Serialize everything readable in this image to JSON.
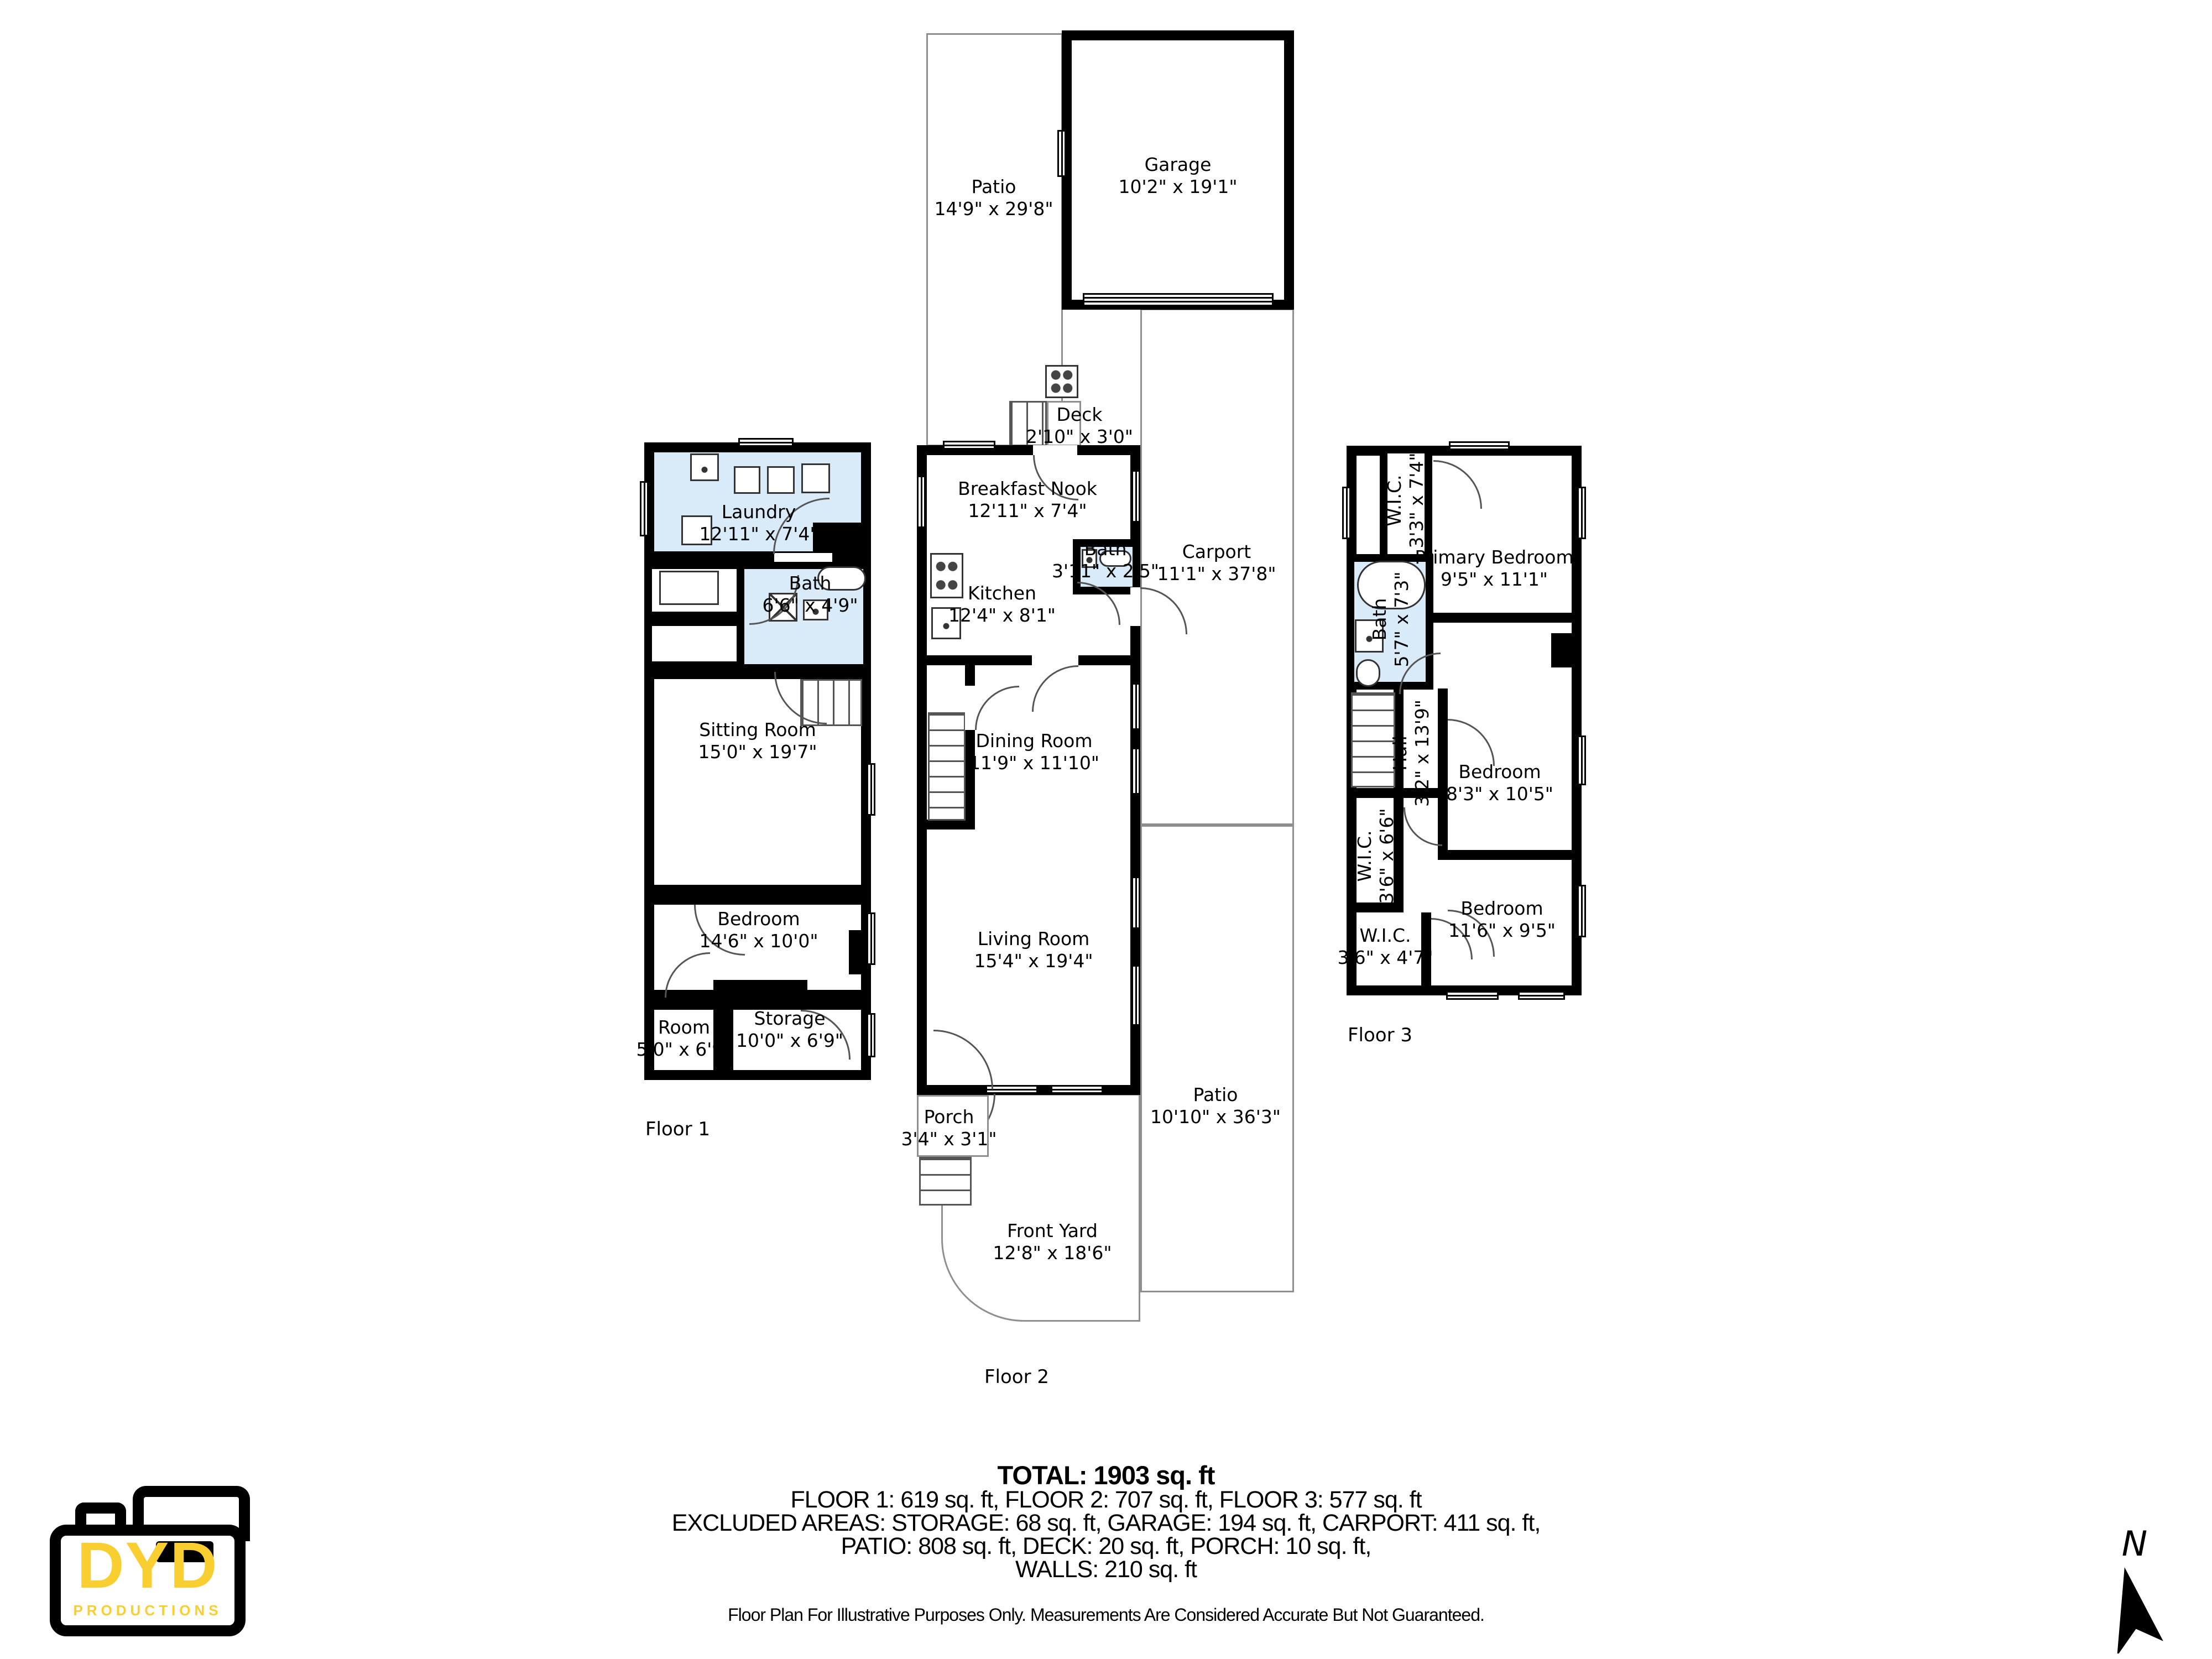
{
  "plan": {
    "floor1": {
      "label": "Floor 1",
      "laundry": {
        "name": "Laundry",
        "dims": "12'11\" x 7'4\""
      },
      "bath": {
        "name": "Bath",
        "dims": "6'6\" x 4'9\""
      },
      "sitting": {
        "name": "Sitting Room",
        "dims": "15'0\" x 19'7\""
      },
      "bedroom": {
        "name": "Bedroom",
        "dims": "14'6\" x 10'0\""
      },
      "room": {
        "name": "Room",
        "dims": "5'0\" x 6'9\""
      },
      "storage": {
        "name": "Storage",
        "dims": "10'0\" x 6'9\""
      }
    },
    "floor2": {
      "label": "Floor 2",
      "patio_back": {
        "name": "Patio",
        "dims": "14'9\" x 29'8\""
      },
      "garage": {
        "name": "Garage",
        "dims": "10'2\" x 19'1\""
      },
      "deck": {
        "name": "Deck",
        "dims": "2'10\" x 3'0\""
      },
      "breakfast": {
        "name": "Breakfast Nook",
        "dims": "12'11\" x 7'4\""
      },
      "bath": {
        "name": "Bath",
        "dims": "3'11\" x 2'5\""
      },
      "carport": {
        "name": "Carport",
        "dims": "11'1\" x 37'8\""
      },
      "kitchen": {
        "name": "Kitchen",
        "dims": "12'4\" x 8'1\""
      },
      "dining": {
        "name": "Dining Room",
        "dims": "11'9\" x 11'10\""
      },
      "living": {
        "name": "Living Room",
        "dims": "15'4\" x 19'4\""
      },
      "porch": {
        "name": "Porch",
        "dims": "3'4\" x 3'1\""
      },
      "patio_front": {
        "name": "Patio",
        "dims": "10'10\" x 36'3\""
      },
      "front_yard": {
        "name": "Front Yard",
        "dims": "12'8\" x 18'6\""
      }
    },
    "floor3": {
      "label": "Floor 3",
      "wic_top": {
        "name": "W.I.C.",
        "dims": "3'3\" x 7'4\""
      },
      "primary": {
        "name": "Primary Bedroom",
        "dims": "9'5\" x 11'1\""
      },
      "bath": {
        "name": "Bath",
        "dims": "5'7\" x 7'3\""
      },
      "hall": {
        "name": "Hall",
        "dims": "3'2\" x 13'9\""
      },
      "bedroom_mid": {
        "name": "Bedroom",
        "dims": "8'3\" x 10'5\""
      },
      "wic_mid": {
        "name": "W.I.C.",
        "dims": "3'6\" x 6'6\""
      },
      "wic_bottom": {
        "name": "W.I.C.",
        "dims": "3'6\" x 4'7\""
      },
      "bedroom_bottom": {
        "name": "Bedroom",
        "dims": "11'6\" x 9'5\""
      }
    }
  },
  "summary": {
    "total": "TOTAL: 1903 sq. ft",
    "floors_line": "FLOOR 1: 619 sq. ft, FLOOR 2: 707 sq. ft, FLOOR 3: 577 sq. ft",
    "excluded_line": "EXCLUDED AREAS: STORAGE: 68 sq. ft, GARAGE: 194 sq. ft, CARPORT: 411 sq. ft,",
    "areas_line": "PATIO: 808 sq. ft, DECK: 20 sq. ft, PORCH: 10 sq. ft,",
    "walls_line": "WALLS: 210 sq. ft",
    "disclaimer": "Floor Plan For Illustrative Purposes Only. Measurements Are Considered Accurate But Not Guaranteed."
  },
  "logo": {
    "brand": "DYD",
    "sub": "PRODUCTIONS",
    "accent": "#F9CE30"
  },
  "compass": {
    "label": "N"
  },
  "colors": {
    "wall": "#000000",
    "bath_fill": "#D9EAF8",
    "outline": "#8F8F8F"
  }
}
